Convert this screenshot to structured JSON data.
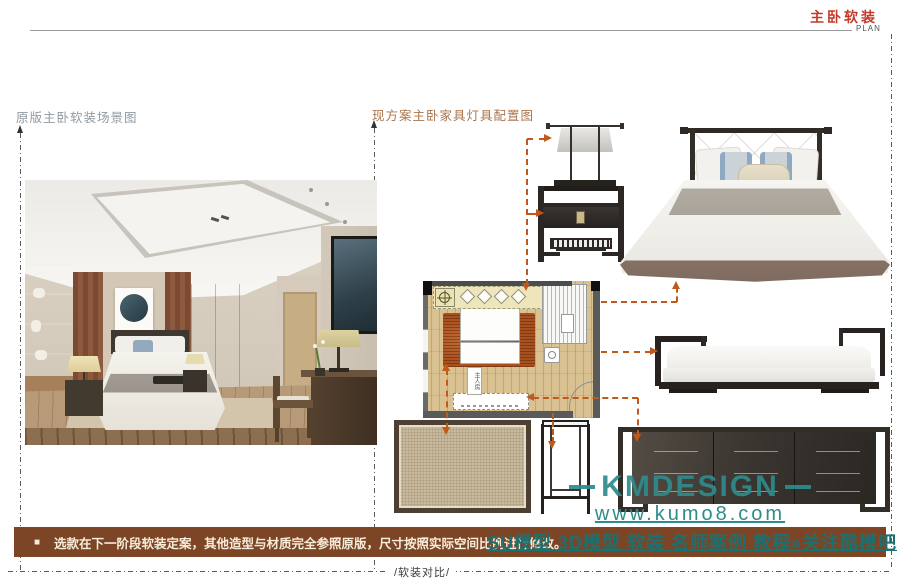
{
  "header": {
    "title": "主卧软装",
    "subtitle": "PLAN"
  },
  "labels": {
    "left_section": "原版主卧软装场景图",
    "right_section": "现方案主卧家具灯具配置图"
  },
  "plan": {
    "room_label": "主人房"
  },
  "watermark": {
    "brand": "KMDESIGN",
    "url": "www.kumo8.com",
    "bar_overlay": "SU模型 3D模型 软装 名师案例 教程»关注酷模吧"
  },
  "footer": {
    "bullet": "■",
    "note": "选款在下一阶段软装定案，其他造型与材质完全参照原版，尺寸按照实际空间比例进行修改。",
    "divider_label": "/软装对比/"
  },
  "colors": {
    "accent_red": "#c43a2b",
    "arrow_orange": "#c05a1a",
    "watermark_teal": "#2e8c8c",
    "footer_brown": "#7c4526"
  }
}
